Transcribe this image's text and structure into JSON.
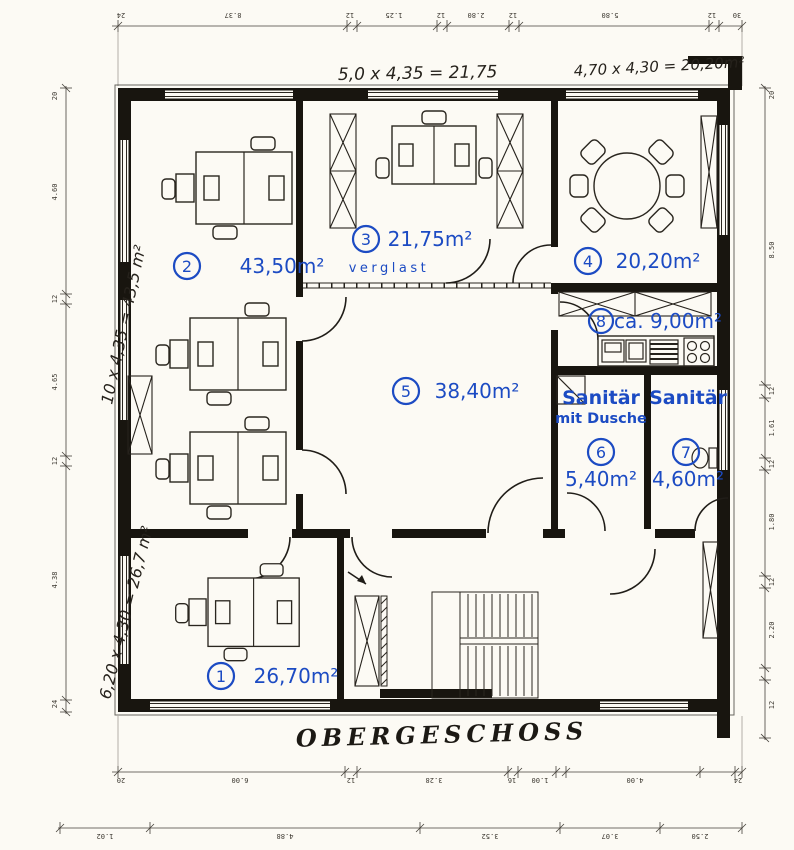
{
  "plan": {
    "title": "OBERGESCHOSS",
    "annotation_color": "#1c4bc3",
    "glazing_label": "verglast",
    "handwritten": {
      "top_left": "5,0 x 4,35 = 21,75",
      "top_right": "4,70 x 4,30 = 20,20m²",
      "left_upper": "10 x 4,35 = 43,5 m²",
      "left_lower": "6,20 x 4,30 = 26,7 m²"
    },
    "rooms": {
      "r1": {
        "num": "1",
        "area": "26,70m²"
      },
      "r2": {
        "num": "2",
        "area": "43,50m²"
      },
      "r3": {
        "num": "3",
        "area": "21,75m²"
      },
      "r4": {
        "num": "4",
        "area": "20,20m²"
      },
      "r5": {
        "num": "5",
        "area": "38,40m²"
      },
      "r6": {
        "num": "6",
        "area": "5,40m²",
        "name": "Sanitär",
        "name2": "mit Dusche"
      },
      "r7": {
        "num": "7",
        "area": "4,60m²",
        "name": "Sanitär"
      },
      "r8": {
        "num": "8",
        "area": "ca. 9,00m²"
      }
    },
    "dimensions": {
      "top": [
        "24",
        "8.37",
        "12",
        "1.25",
        "12",
        "2.80",
        "12",
        "5.80",
        "12",
        "30"
      ],
      "left": [
        "20",
        "4.60",
        "12",
        "4.65",
        "12",
        "4.38",
        "24"
      ],
      "right": [
        "20",
        "8.50",
        "12",
        "1.61",
        "12",
        "1.80",
        "12",
        "2.20",
        "12"
      ],
      "bottom1": [
        "20",
        "6.00",
        "12",
        "3.28",
        "16",
        "1.00",
        "4.00",
        "24"
      ],
      "bottom2": [
        "1.02",
        "4.88",
        "3.52",
        "3.07",
        "2.50"
      ]
    }
  }
}
